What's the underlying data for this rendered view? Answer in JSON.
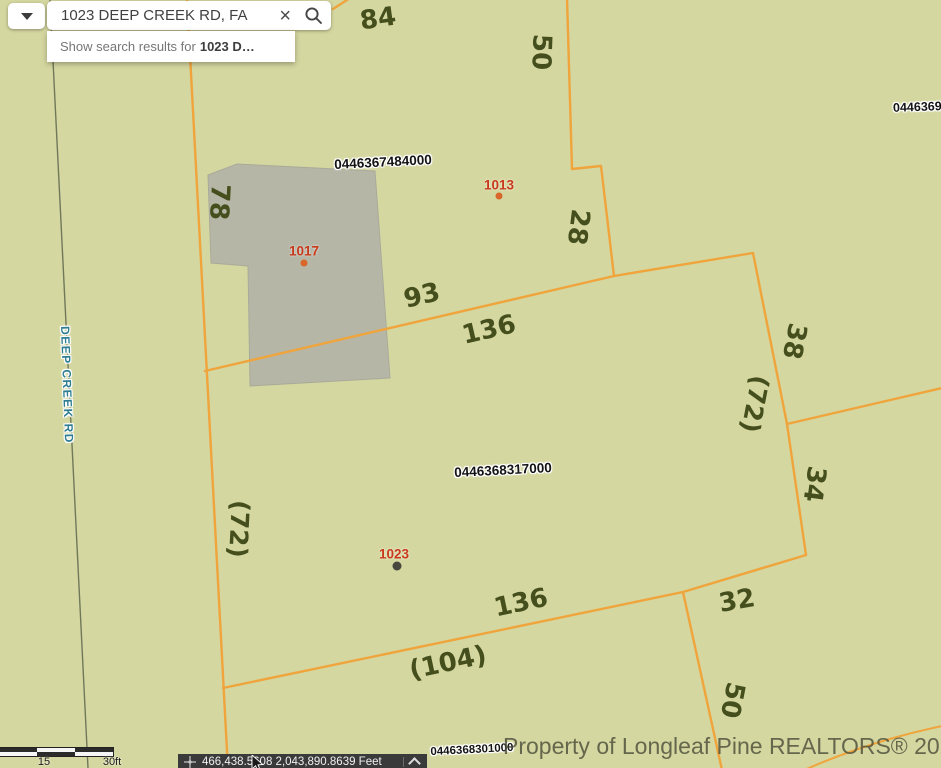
{
  "search": {
    "query": "1023 DEEP CREEK RD, FA",
    "suggestion_prefix": "Show search results for",
    "suggestion_term": "1023 D…"
  },
  "map": {
    "road_label": "DEEP CREEK RD",
    "parcel_ids": {
      "top": "0446367484000",
      "middle": "0446368317000",
      "bottom": "0446368301000",
      "top_right_partial": "0446369"
    },
    "address_points": [
      {
        "label": "1013"
      },
      {
        "label": "1017"
      },
      {
        "label": "1023"
      }
    ],
    "dimensions": {
      "d84": "84",
      "d50_top": "50",
      "d78": "78",
      "d28": "28",
      "d93": "93",
      "d136_top": "136",
      "d38": "38",
      "d72_right": "(72)",
      "d34": "34",
      "d72_left": "(72)",
      "d136_bottom": "136",
      "d32": "32",
      "d104": "(104)",
      "d50_bottom": "50"
    }
  },
  "scale_bar": {
    "mid_label": "15",
    "end_label": "30ft"
  },
  "status_bar": {
    "coordinates": "466,438.5608 2,043,890.8639 Feet"
  },
  "watermark": "Property of Longleaf Pine REALTORS® 2024",
  "colors": {
    "map_background": "#d5d7a0",
    "parcel_line": "#efa43c",
    "dimension_text": "#454f1d",
    "address_text": "#c8391b",
    "address_dot": "#d9662a",
    "selected_dot": "#47473e",
    "road_label": "#2e7d92",
    "building_fill": "#b5b6a6",
    "statusbar_bg": "#3a3a3a"
  }
}
